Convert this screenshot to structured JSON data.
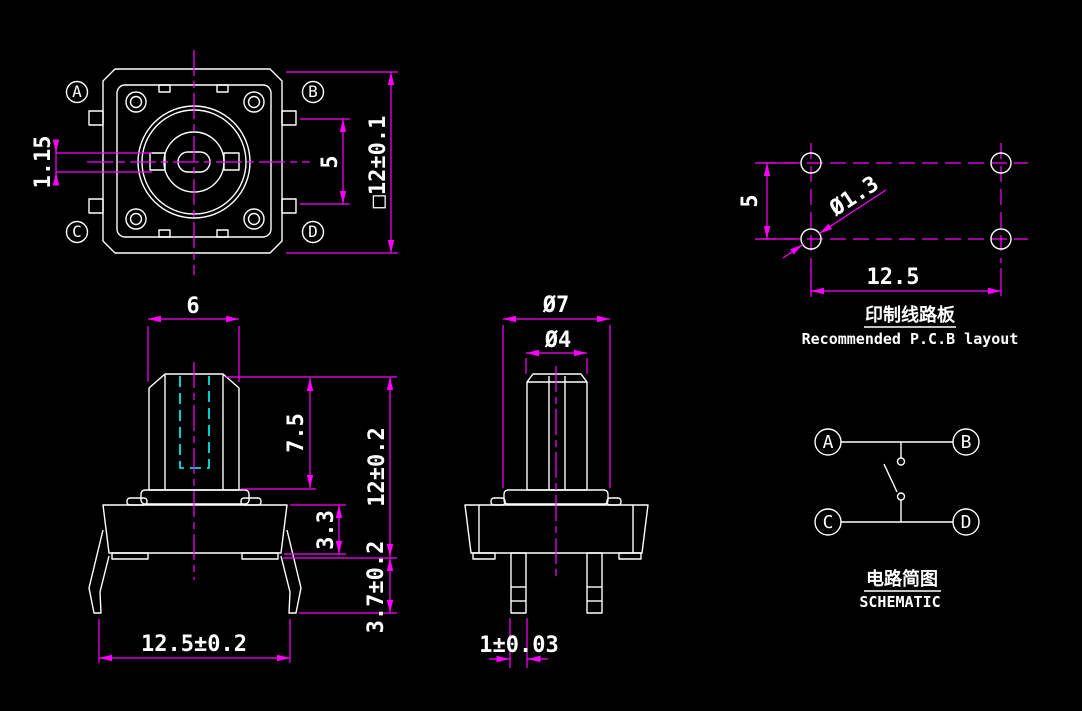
{
  "colors": {
    "background": "#000000",
    "outline": "#ffffff",
    "dimension": "#ff00ff",
    "hidden_line": "#00ffff",
    "text": "#ffffff"
  },
  "top_view": {
    "labels": [
      "A",
      "B",
      "C",
      "D"
    ],
    "dim_slot": "1.15",
    "dim_tab_spacing": "5",
    "dim_body": "□12±0.1"
  },
  "front_view": {
    "dim_stem_width": "6",
    "dim_stem_height": "7.5",
    "dim_total_height": "12±0.2",
    "dim_body_height": "3.3",
    "dim_leg_height": "3.7±0.2",
    "dim_base_width": "12.5±0.2"
  },
  "side_view": {
    "dim_collar_dia": "Ø7",
    "dim_stem_dia": "Ø4",
    "dim_leg_width": "1±0.03"
  },
  "pcb_layout": {
    "title_zh": "印制线路板",
    "title_en": "Recommended P.C.B layout",
    "dim_row_spacing": "5",
    "dim_hole_dia": "Ø1.3",
    "dim_col_spacing": "12.5"
  },
  "schematic": {
    "title_zh": "电路简图",
    "title_en": "SCHEMATIC",
    "terminals": [
      "A",
      "B",
      "C",
      "D"
    ]
  }
}
